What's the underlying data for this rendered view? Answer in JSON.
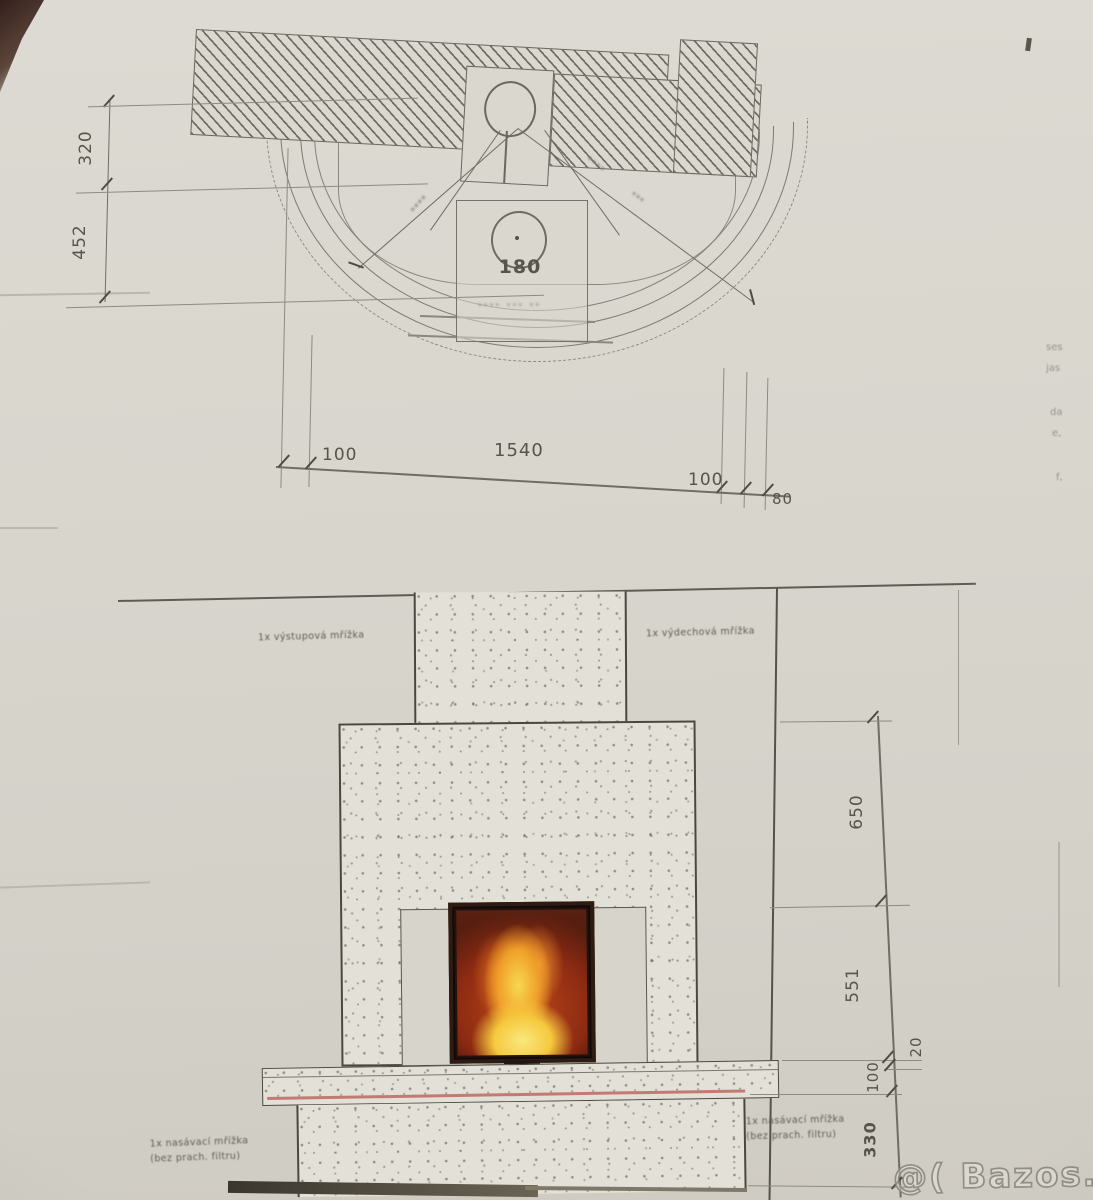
{
  "watermark": "@( Bazos.cz",
  "plan": {
    "flue_diameter": "180",
    "detail_note": "∙∙∙∙ ∙∙∙ ∙∙",
    "radius_smudge_1": "∙∙∙∙",
    "radius_smudge_2": "∙∙∙∙",
    "radius_smudge_3": "∙∙∙",
    "dims_left": [
      "320",
      "452"
    ],
    "dims_bottom": [
      "100",
      "1540",
      "100",
      "80"
    ]
  },
  "elevation": {
    "label_left_grille": "1x výstupová mřížka",
    "label_right_grille": "1x výdechová mřížka",
    "label_bottom_left_line1": "1x nasávací mřížka",
    "label_bottom_left_line2": "(bez prach. filtru)",
    "label_bottom_right_line1": "1x nasávací mřížka",
    "label_bottom_right_line2": "(bez prach. filtru)",
    "dims_right": [
      "650",
      "551",
      "20",
      "100",
      "330"
    ]
  },
  "edge_fragments": [
    "ses",
    "jas",
    "da",
    "e,",
    "f,"
  ],
  "colors": {
    "paper": "#d8d6cd",
    "ink": "#57544c",
    "fire_orange": "#f0a02a",
    "hearth_red_line": "#c27b72"
  }
}
